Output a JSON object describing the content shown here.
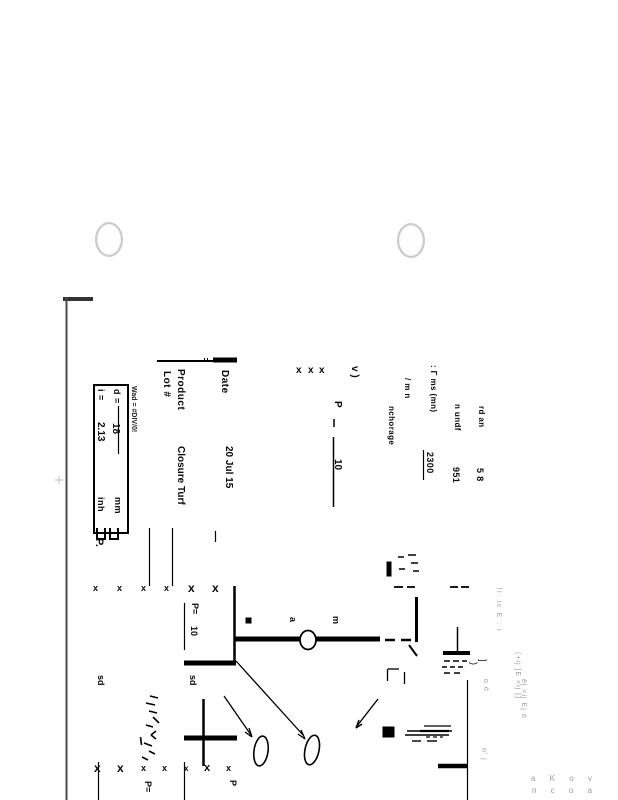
{
  "scan": {
    "header": {
      "date_label": "Date",
      "date_value": "20 Jul 15",
      "product_label": "Product",
      "product_value": "Closure Turf",
      "lot_label": "Lot #"
    },
    "params_box": {
      "wad_note": "Wad = #DIV/0!",
      "d_label": "d =",
      "d_value": "18",
      "d_unit": "mm",
      "i_label": "i =",
      "i_value": "2.13",
      "i_unit": "inh",
      "p_mark": "P."
    },
    "top_fragments": {
      "anchorage": "nchorage",
      "slash_mn": "/ m n",
      "ms_mn": ": Γ  ms (mn)",
      "ms_value": "2300",
      "undf": "n undf",
      "undf_value": "951",
      "rd_an": "rd an",
      "rd_value": "5 8"
    },
    "hand": {
      "x": "x",
      "check": "v )",
      "p": "P",
      "p_value": "10",
      "p_eq": "P=",
      "p_eq_value": "10",
      "sd": "sd",
      "p_small": "P",
      "a": "a",
      "m": "m",
      "paren": ")",
      "bracket": "]"
    },
    "faint": {
      "f1": "li: ic E : i",
      "f2": "(+ij ]E <ij [)",
      "f3": "o ö",
      "f4": "ëj <ij Ej ö",
      "f5": "n' j",
      "f6": "a K o v",
      "f7": "n c o a"
    }
  }
}
